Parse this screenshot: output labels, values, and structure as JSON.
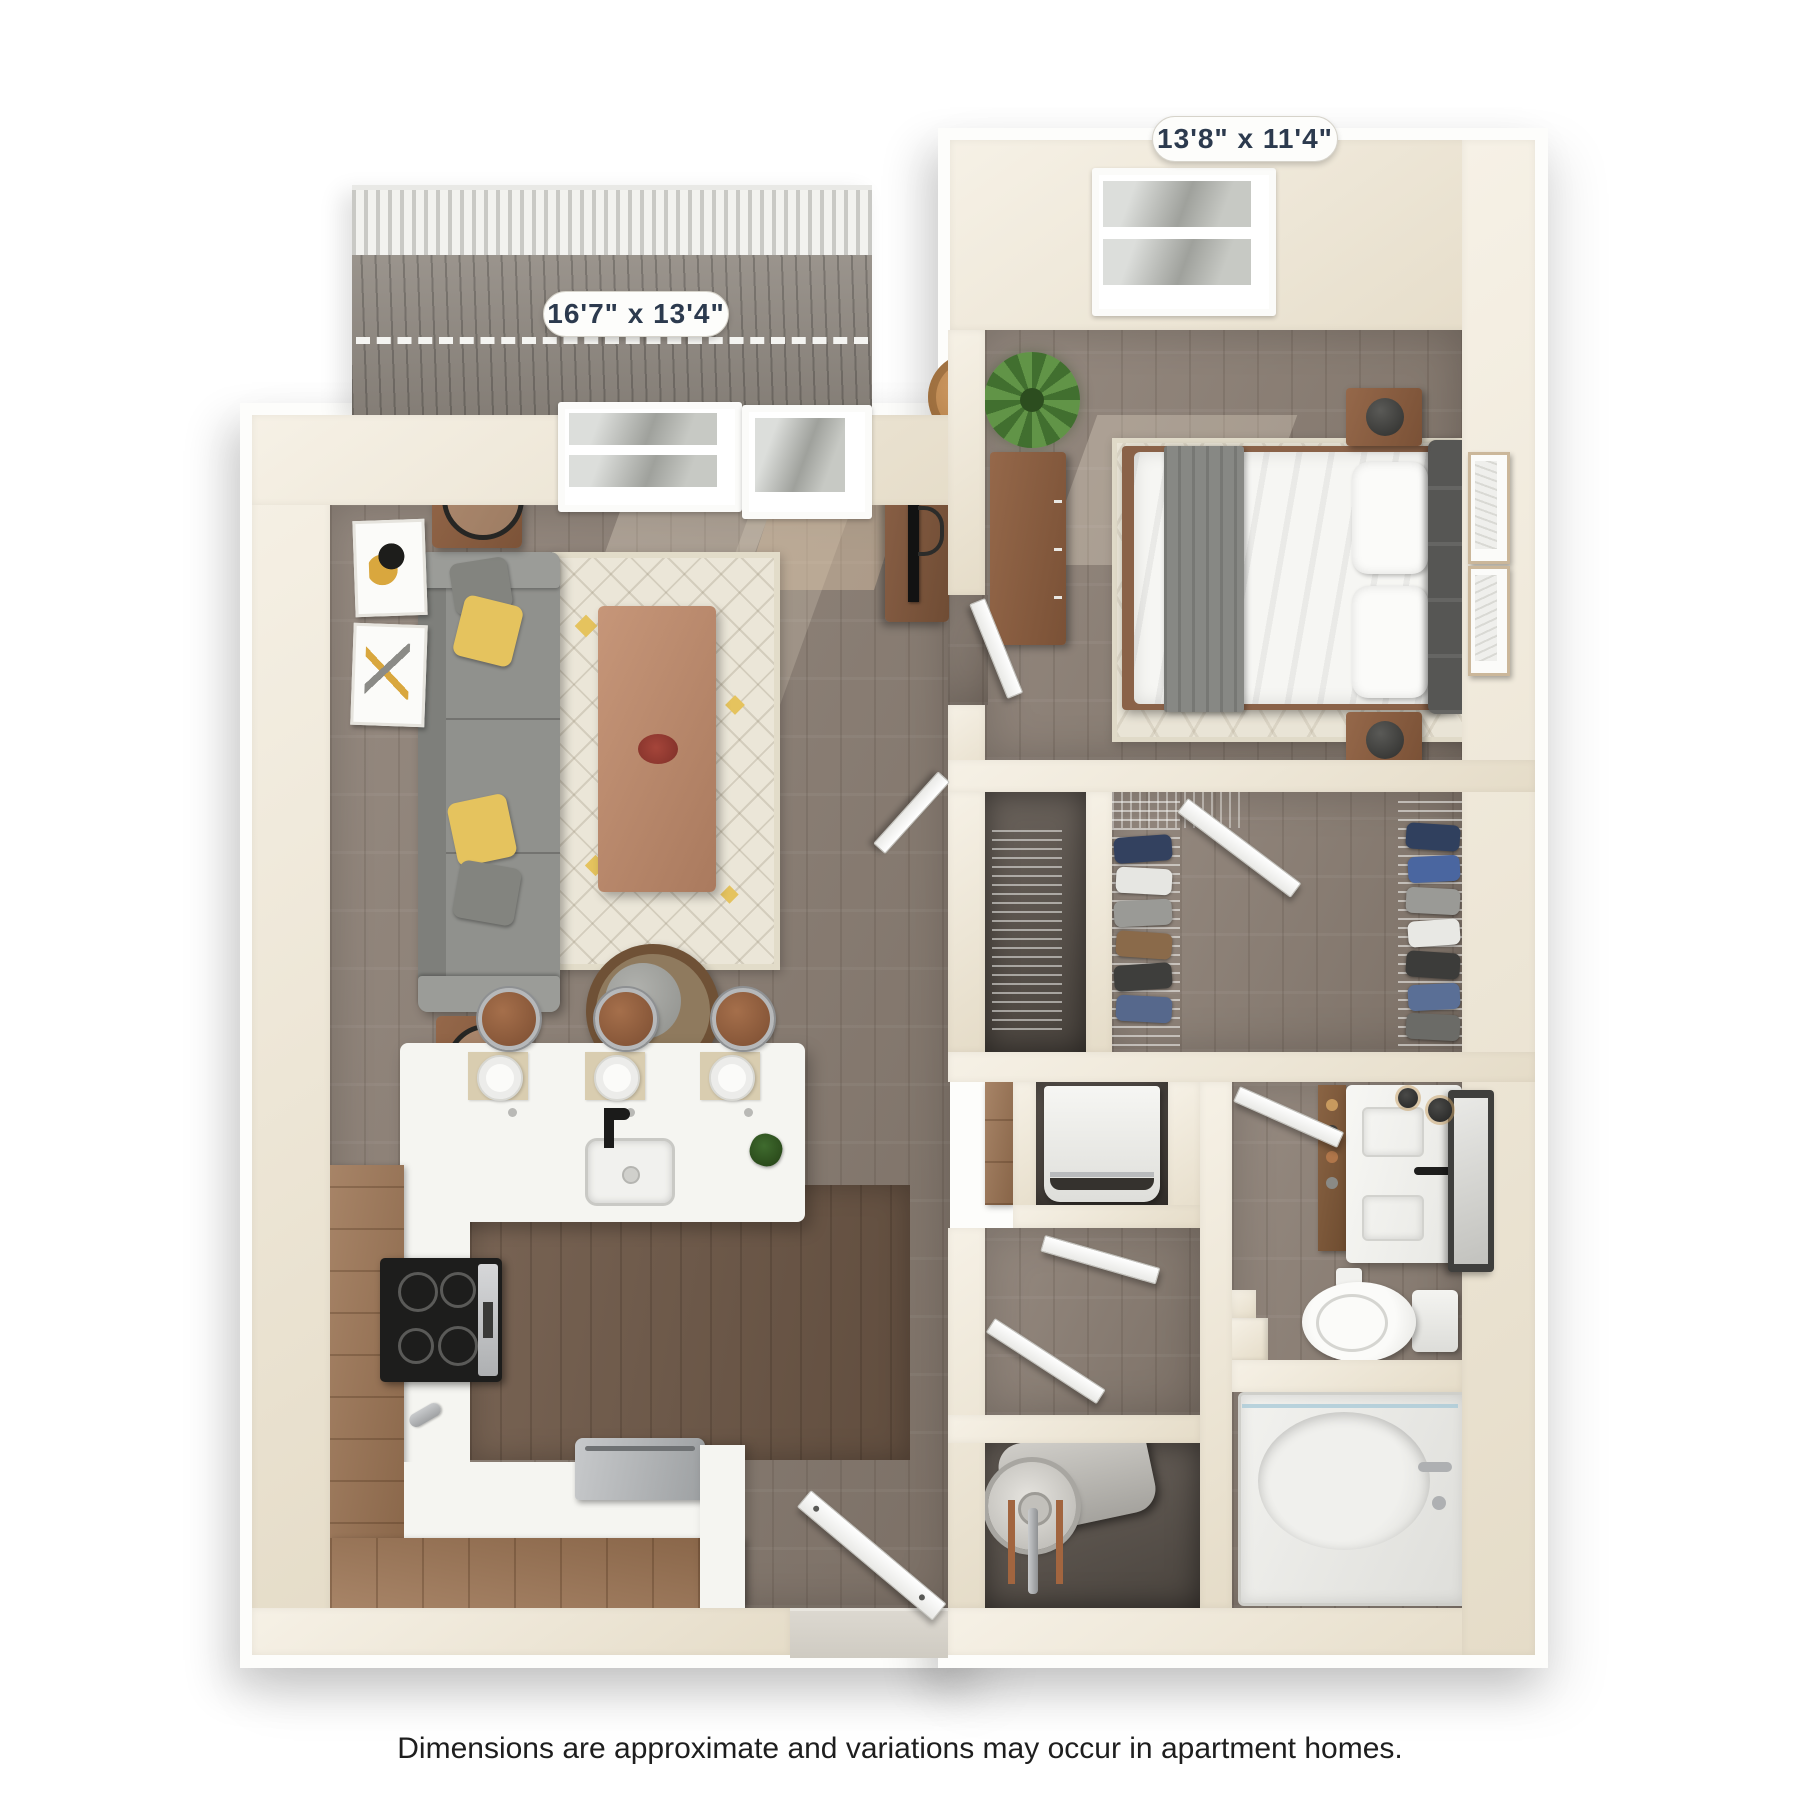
{
  "labels": {
    "bedroom_dimensions": "13'8\" x 11'4\"",
    "living_room_dimensions": "16'7\" x 13'4\""
  },
  "caption": "Dimensions are approximate and variations may occur in apartment homes.",
  "palette": {
    "wall": "#efe8da",
    "floor_wood": "#8a7d72",
    "kitchen_floor_wood": "#6e5847",
    "cabinet_wood": "#9b7352",
    "accent_yellow": "#e5c35e",
    "sofa_gray": "#90918d",
    "fixture_white": "#f6f6f3",
    "label_text": "#2c3a4e"
  }
}
